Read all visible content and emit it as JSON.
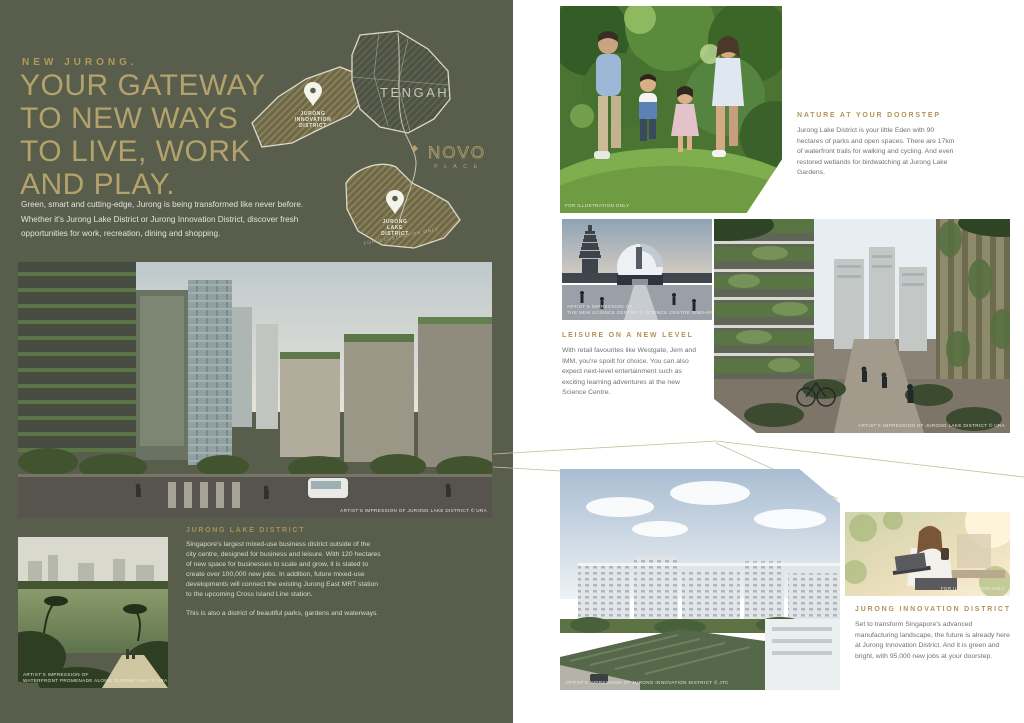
{
  "left": {
    "kicker": "NEW JURONG.",
    "headline": [
      "YOUR GATEWAY",
      "TO NEW WAYS",
      "TO LIVE, WORK",
      "AND PLAY."
    ],
    "intro": "Green, smart and cutting-edge, Jurong is being transformed like never before. Whether it's Jurong Lake District or Jurong Innovation District, discover fresh opportunities for work, recreation, dining and shopping.",
    "map": {
      "tengah": "TENGAH",
      "pin_innovation_l1": "JURONG",
      "pin_innovation_l2": "INNOVATION",
      "pin_innovation_l3": "DISTRICT",
      "pin_lake_l1": "JURONG",
      "pin_lake_l2": "LAKE",
      "pin_lake_l3": "DISTRICT",
      "novo": "NOVO",
      "novo_sub": "P L A C E",
      "disclaimer": "FOR ILLUSTRATION ONLY"
    },
    "main_image_caption": "ARTIST'S IMPRESSION OF JURONG LAKE DISTRICT © URA",
    "promenade_caption_l1": "ARTIST'S IMPRESSION OF",
    "promenade_caption_l2": "WATERFRONT PROMENADE ALONG JURONG LAKE © URA",
    "lake_district": {
      "heading": "JURONG LAKE DISTRICT",
      "para1": "Singapore's largest mixed-use business district outside of the city centre, designed for business and leisure. With 120 hectares of new space for businesses to scale and grow, it is slated to create over 100,000 new jobs. In addition, future mixed-use developments will connect the existing Jurong East MRT station to the upcoming Cross Island Line station.",
      "para2": "This is also a district of beautiful parks, gardens and waterways."
    }
  },
  "right": {
    "family_caption": "FOR ILLUSTRATION ONLY",
    "nature": {
      "heading": "NATURE AT YOUR DOORSTEP",
      "body": "Jurong Lake District is your little Eden with 90 hectares of parks and open spaces. There are 17km of waterfront trails for walking and cycling. And even restored wetlands for birdwatching at Jurong Lake Gardens."
    },
    "science_caption_l1": "ARTIST'S IMPRESSION OF",
    "science_caption_l2": "THE NEW SCIENCE CENTRE © SCIENCE CENTRE SINGAPORE",
    "street_caption": "ARTIST'S IMPRESSION OF JURONG LAKE DISTRICT © URA",
    "leisure": {
      "heading": "LEISURE ON A NEW LEVEL",
      "body": "With retail favourites like Westgate, Jem and IMM, you're spoilt for choice. You can also expect next-level entertainment such as exciting learning adventures at the new Science Centre."
    },
    "estate_caption": "ARTIST'S IMPRESSION OF JURONG INNOVATION DISTRICT © JTC",
    "woman_caption": "FOR ILLUSTRATION ONLY",
    "innovation": {
      "heading": "JURONG INNOVATION DISTRICT",
      "body": "Set to transform Singapore's advanced manufacturing landscape, the future is already here at Jurong Innovation District. And it is green and bright, with 95,000 new jobs at your doorstep."
    }
  },
  "colors": {
    "panel_green": "#585d4c",
    "gold": "#b29a58",
    "gold_light": "#b4a26c",
    "body_gray": "#707176"
  }
}
